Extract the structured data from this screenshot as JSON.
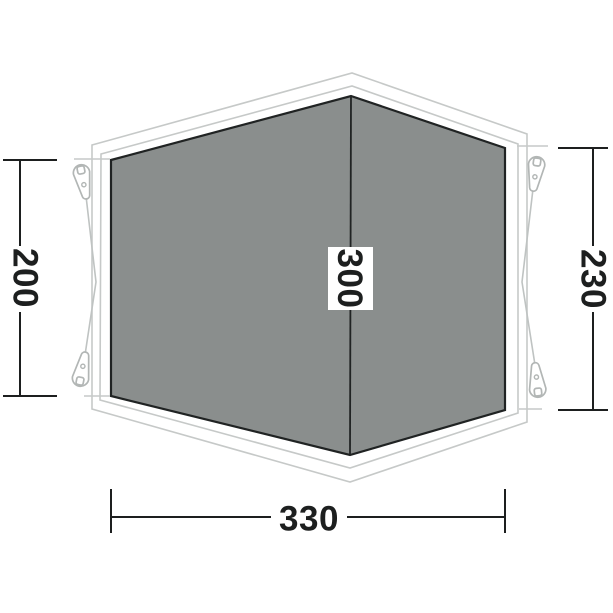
{
  "diagram": {
    "dimensions": {
      "left": {
        "value": "200"
      },
      "right": {
        "value": "230"
      },
      "ridge": {
        "value": "300"
      },
      "width": {
        "value": "330"
      }
    },
    "colors": {
      "groundsheet_fill": "#8a8e8d",
      "groundsheet_stroke": "#202323",
      "flysheet_outline": "#c6c9c8",
      "peg_loop_stroke": "#b2b6b5",
      "dimension_line": "#1d1f1f",
      "label_background": "#ffffff"
    },
    "icons": {
      "corner_attachments": "peg-loop-icon"
    }
  }
}
